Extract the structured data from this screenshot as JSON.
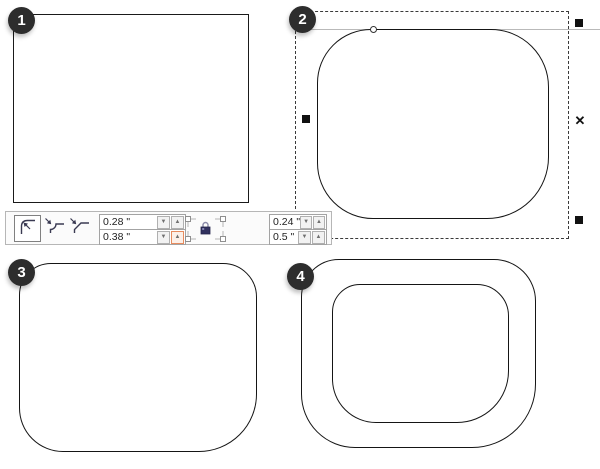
{
  "badges": {
    "step1": "1",
    "step2": "2",
    "step3": "3",
    "step4": "4"
  },
  "toolbar": {
    "corner_style_buttons": [
      {
        "name": "round-corner",
        "selected": true
      },
      {
        "name": "scalloped-corner",
        "selected": false
      },
      {
        "name": "chamfered-corner",
        "selected": false
      }
    ],
    "left_fields": {
      "top": "0.28 \"",
      "bottom": "0.38 \""
    },
    "right_fields": {
      "top": "0.24 \"",
      "bottom": "0.5 \""
    },
    "glyphs": {
      "spinner_down": "▼",
      "spinner_up": "▲"
    },
    "corners_locked_together": false
  },
  "selection": {
    "x_marker": "✕"
  },
  "colors": {
    "outline": "#1a1a1a",
    "badge": "#2d2d2d",
    "toolbar_border": "#b6b6b6",
    "field_border": "#a3a3a3",
    "spinner_highlight": "#e78b5e",
    "lock_navy": "#31315e",
    "guide_line": "#b9b9b9"
  }
}
